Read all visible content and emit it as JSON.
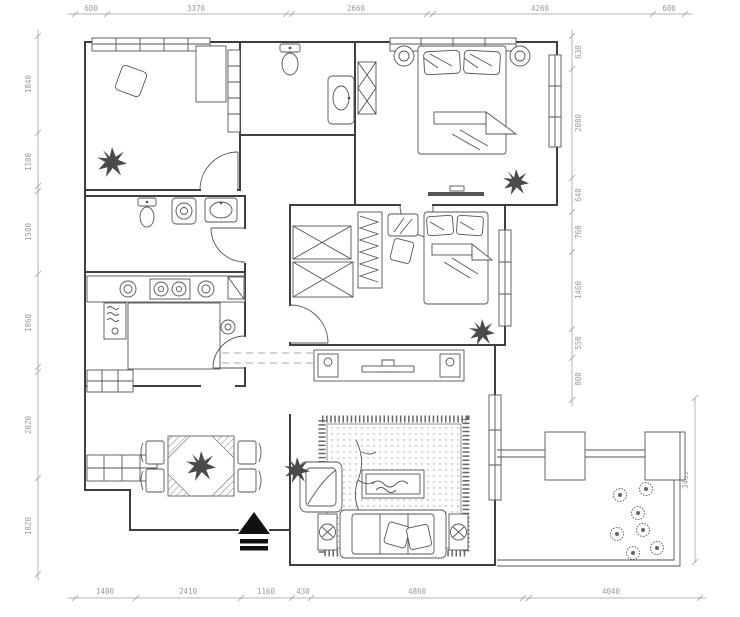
{
  "drawing": {
    "background": "#ffffff",
    "wall_color": "#3f3f3f",
    "furniture_color": "#555555",
    "dimension_color": "#9b9b9b",
    "entry_arrow_color": "#111111"
  },
  "dims": {
    "top": [
      "600",
      "3370",
      "2660",
      "4260",
      "600"
    ],
    "left": [
      "1840",
      "1100",
      "1580",
      "1860",
      "2020",
      "1820"
    ],
    "right": [
      "630",
      "2080",
      "640",
      "760",
      "1460",
      "550",
      "800"
    ],
    "right_outer": "3465",
    "bottom": [
      "1400",
      "2410",
      "1160",
      "430",
      "4860",
      "4040"
    ]
  },
  "symbols": [
    "window-band-icon",
    "door-arc-icon",
    "plant-icon",
    "flower-icon",
    "bed-icon",
    "pillow-icon",
    "wardrobe-icon",
    "x-cabinet-icon",
    "toilet-icon",
    "vanity-sink-icon",
    "washer-icon",
    "stove-icon",
    "fridge-icon",
    "kitchen-island-icon",
    "dining-table-icon",
    "chair-icon",
    "sofa-icon",
    "armchair-icon",
    "coffee-table-icon",
    "tv-console-icon",
    "rug-icon",
    "side-table-icon",
    "entry-arrow-icon",
    "column-icon",
    "railing-icon",
    "desk-icon",
    "shelf-icon",
    "mirror-icon"
  ]
}
